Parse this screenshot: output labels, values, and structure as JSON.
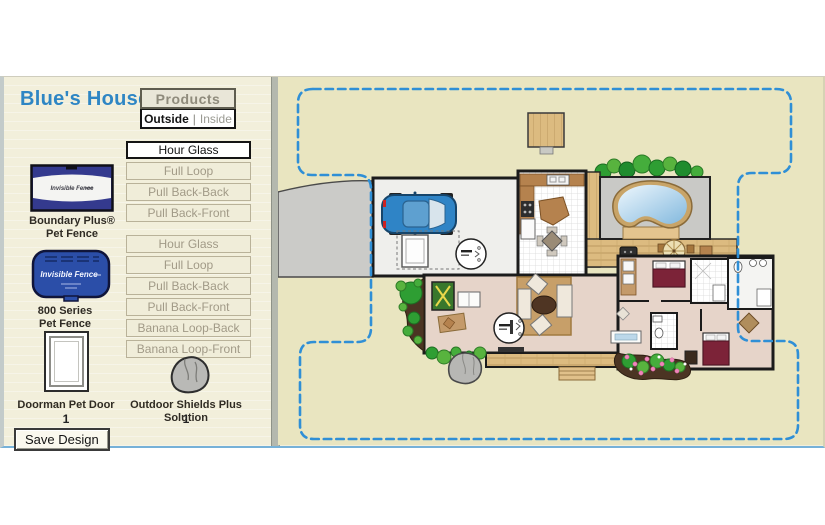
{
  "window": {
    "title": "Blue's House"
  },
  "sidebar": {
    "title": "Blue's House",
    "products_header": "Products",
    "tabs": {
      "outside": "Outside",
      "separator": "|",
      "inside": "Inside"
    },
    "layout_buttons_top": [
      {
        "label": "Hour Glass",
        "active": true
      },
      {
        "label": "Full Loop",
        "active": false
      },
      {
        "label": "Pull Back-Back",
        "active": false
      },
      {
        "label": "Pull Back-Front",
        "active": false
      }
    ],
    "layout_buttons_bottom": [
      {
        "label": "Hour Glass",
        "active": false
      },
      {
        "label": "Full Loop",
        "active": false
      },
      {
        "label": "Pull Back-Back",
        "active": false
      },
      {
        "label": "Pull Back-Front",
        "active": false
      },
      {
        "label": "Banana Loop-Back",
        "active": false
      },
      {
        "label": "Banana Loop-Front",
        "active": false
      }
    ],
    "products": {
      "boundary_plus": {
        "brand_text": "Invisible Fence",
        "label_line1": "Boundary Plus®",
        "label_line2": "Pet Fence"
      },
      "series_800": {
        "brand_text": "Invisible Fence",
        "label_line1": "800 Series",
        "label_line2": "Pet Fence"
      },
      "doorman": {
        "label": "Doorman Pet Door",
        "count": "1"
      },
      "outdoor_shields": {
        "label": "Outdoor Shields Plus Solution",
        "count": "1"
      }
    },
    "save_button_label": "Save Design"
  },
  "map": {
    "total_amount_label": "Total Amount",
    "total_amount_value": "180.00",
    "selected_layout": "Hour Glass",
    "boundary_color": "#2f8fd6"
  }
}
